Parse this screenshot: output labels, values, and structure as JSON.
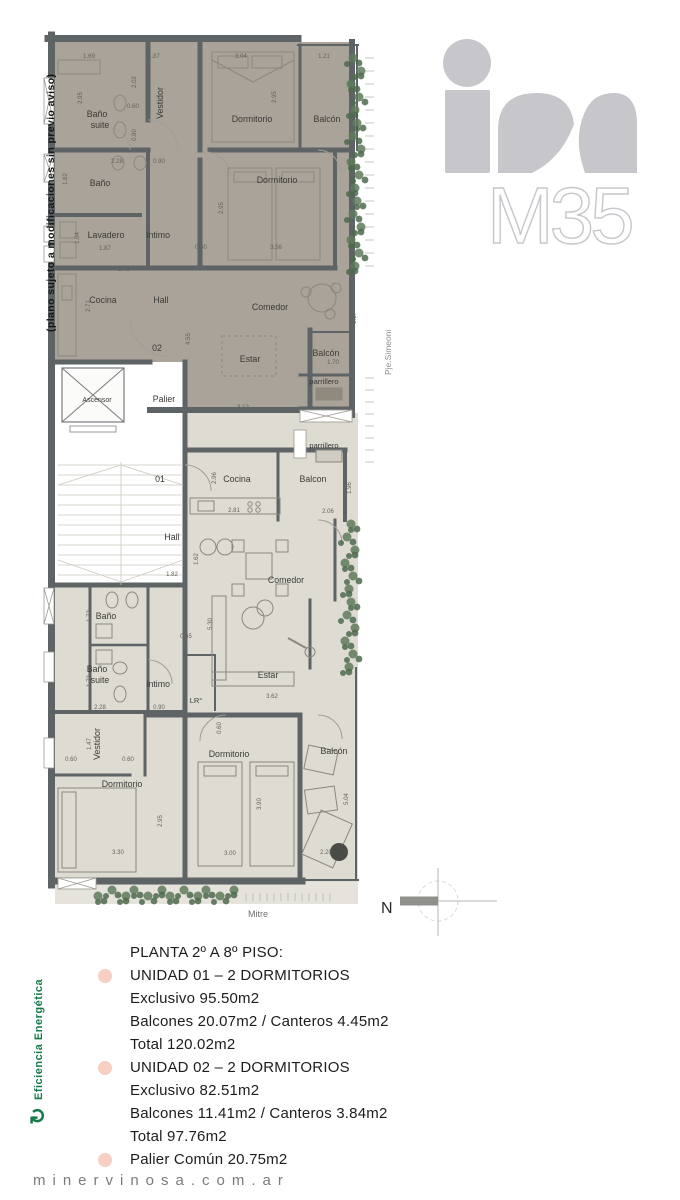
{
  "side_note": "(plano sujeto a modificaciones sin previo aviso)",
  "streets": {
    "right": "Pje.Simeoni",
    "bottom": "Mitre"
  },
  "compass": {
    "north_label": "N"
  },
  "logo": {
    "model": "M35"
  },
  "energy": {
    "label": "Eficiencia Energética",
    "icon": "refresh-arrow",
    "color": "#177a4a"
  },
  "footer": {
    "url": "minervinosa.com.ar"
  },
  "legend": {
    "title": "PLANTA 2º A 8º PISO:",
    "items": [
      {
        "bullet": true,
        "text": "UNIDAD 01 – 2 DORMITORIOS"
      },
      {
        "bullet": false,
        "text": "Exclusivo 95.50m2"
      },
      {
        "bullet": false,
        "text": "Balcones 20.07m2 / Canteros 4.45m2"
      },
      {
        "bullet": false,
        "text": "Total 120.02m2"
      },
      {
        "bullet": true,
        "text": "UNIDAD 02 – 2 DORMITORIOS"
      },
      {
        "bullet": false,
        "text": "Exclusivo 82.51m2"
      },
      {
        "bullet": false,
        "text": "Balcones 11.41m2 / Canteros 3.84m2"
      },
      {
        "bullet": false,
        "text": "Total 97.76m2"
      },
      {
        "bullet": true,
        "text": "Palier Común 20.75m2"
      }
    ]
  },
  "colors": {
    "unit01_fill": "#dedbd3",
    "unit02_fill": "#a9a399",
    "wall": "#5e6366",
    "bullet_pink": "#f7cfc3",
    "plant_green": "#5f7a5b",
    "logo_gray": "#c7c6cb"
  },
  "plan": {
    "rooms": [
      {
        "t": "Baño",
        "x": 97,
        "y": 117
      },
      {
        "t": "suite",
        "x": 100,
        "y": 128
      },
      {
        "t": "Vestidor",
        "x": 163,
        "y": 103,
        "r": -90
      },
      {
        "t": "Dormitorio",
        "x": 252,
        "y": 122
      },
      {
        "t": "Balcón",
        "x": 327,
        "y": 122
      },
      {
        "t": "Baño",
        "x": 100,
        "y": 186
      },
      {
        "t": "Dormitorio",
        "x": 277,
        "y": 183
      },
      {
        "t": "Lavadero",
        "x": 106,
        "y": 238
      },
      {
        "t": "Intimo",
        "x": 158,
        "y": 238
      },
      {
        "t": "Cocina",
        "x": 103,
        "y": 303
      },
      {
        "t": "Hall",
        "x": 161,
        "y": 303
      },
      {
        "t": "Comedor",
        "x": 270,
        "y": 310
      },
      {
        "t": "02",
        "x": 157,
        "y": 351
      },
      {
        "t": "Estar",
        "x": 250,
        "y": 362
      },
      {
        "t": "Balcón",
        "x": 326,
        "y": 356
      },
      {
        "t": "parrillero",
        "x": 324,
        "y": 384,
        "fs": 7.5
      },
      {
        "t": "Ascensor",
        "x": 97,
        "y": 402,
        "fs": 7
      },
      {
        "t": "Palier",
        "x": 164,
        "y": 402
      },
      {
        "t": "parrillero",
        "x": 324,
        "y": 448,
        "fs": 7.5
      },
      {
        "t": "01",
        "x": 160,
        "y": 482
      },
      {
        "t": "Cocina",
        "x": 237,
        "y": 482
      },
      {
        "t": "Balcon",
        "x": 313,
        "y": 482
      },
      {
        "t": "Hall",
        "x": 172,
        "y": 540
      },
      {
        "t": "Comedor",
        "x": 286,
        "y": 583
      },
      {
        "t": "Baño",
        "x": 106,
        "y": 619
      },
      {
        "t": "Baño",
        "x": 97,
        "y": 672
      },
      {
        "t": "suite",
        "x": 100,
        "y": 683
      },
      {
        "t": "Intimo",
        "x": 158,
        "y": 687
      },
      {
        "t": "Estar",
        "x": 268,
        "y": 678
      },
      {
        "t": "LR°",
        "x": 196,
        "y": 703,
        "fs": 7.5
      },
      {
        "t": "Vestidor",
        "x": 100,
        "y": 744,
        "r": -90
      },
      {
        "t": "Dormitorio",
        "x": 122,
        "y": 787
      },
      {
        "t": "Dormitorio",
        "x": 229,
        "y": 757
      },
      {
        "t": "Balcón",
        "x": 334,
        "y": 754
      }
    ],
    "dims": [
      {
        "t": "1.69",
        "x": 89,
        "y": 58
      },
      {
        "t": "1.87",
        "x": 154,
        "y": 58
      },
      {
        "t": "3.04",
        "x": 241,
        "y": 58
      },
      {
        "t": "1.21",
        "x": 324,
        "y": 58
      },
      {
        "t": "2.95",
        "x": 82,
        "y": 98,
        "r": -90
      },
      {
        "t": "2.02",
        "x": 136,
        "y": 82,
        "r": -90
      },
      {
        "t": "0.60",
        "x": 133,
        "y": 108
      },
      {
        "t": "0.80",
        "x": 136,
        "y": 135,
        "r": -90
      },
      {
        "t": "2.95",
        "x": 276,
        "y": 97,
        "r": -90
      },
      {
        "t": "0.90",
        "x": 159,
        "y": 163
      },
      {
        "t": "2.28",
        "x": 117,
        "y": 163
      },
      {
        "t": "1.82",
        "x": 67,
        "y": 179,
        "r": -90
      },
      {
        "t": "1.04",
        "x": 79,
        "y": 238,
        "r": -90
      },
      {
        "t": "1.87",
        "x": 105,
        "y": 250
      },
      {
        "t": "0.40",
        "x": 201,
        "y": 249
      },
      {
        "t": "3.56",
        "x": 276,
        "y": 249
      },
      {
        "t": "2.95",
        "x": 223,
        "y": 208,
        "r": -90
      },
      {
        "t": "2.43",
        "x": 124,
        "y": 271
      },
      {
        "t": "1.40",
        "x": 162,
        "y": 270
      },
      {
        "t": "2.71",
        "x": 90,
        "y": 306,
        "r": -90
      },
      {
        "t": "3.17",
        "x": 356,
        "y": 318,
        "r": -90
      },
      {
        "t": "4.55",
        "x": 190,
        "y": 339,
        "r": -90
      },
      {
        "t": "3.12",
        "x": 243,
        "y": 409
      },
      {
        "t": "1.70",
        "x": 333,
        "y": 364
      },
      {
        "t": "2.96",
        "x": 216,
        "y": 478,
        "r": -90
      },
      {
        "t": "2.81",
        "x": 234,
        "y": 512
      },
      {
        "t": "2.06",
        "x": 328,
        "y": 513
      },
      {
        "t": "1.96",
        "x": 351,
        "y": 488,
        "r": -90
      },
      {
        "t": "1.62",
        "x": 198,
        "y": 559,
        "r": -90
      },
      {
        "t": "1.82",
        "x": 172,
        "y": 576
      },
      {
        "t": "0.65",
        "x": 186,
        "y": 638
      },
      {
        "t": "5.30",
        "x": 212,
        "y": 624,
        "r": -90
      },
      {
        "t": "3.62",
        "x": 272,
        "y": 698
      },
      {
        "t": "0.60",
        "x": 221,
        "y": 728,
        "r": -90
      },
      {
        "t": "1.72",
        "x": 91,
        "y": 616,
        "r": -90
      },
      {
        "t": "1.73",
        "x": 91,
        "y": 681,
        "r": -90
      },
      {
        "t": "2.28",
        "x": 100,
        "y": 709
      },
      {
        "t": "0.90",
        "x": 159,
        "y": 709
      },
      {
        "t": "1.47",
        "x": 91,
        "y": 744,
        "r": -90
      },
      {
        "t": "0.60",
        "x": 71,
        "y": 761
      },
      {
        "t": "0.60",
        "x": 128,
        "y": 761
      },
      {
        "t": "3.30",
        "x": 118,
        "y": 854
      },
      {
        "t": "2.95",
        "x": 162,
        "y": 821,
        "r": -90
      },
      {
        "t": "3.00",
        "x": 230,
        "y": 855
      },
      {
        "t": "3.90",
        "x": 261,
        "y": 804,
        "r": -90
      },
      {
        "t": "5.04",
        "x": 348,
        "y": 799,
        "r": -90
      },
      {
        "t": "2.20",
        "x": 326,
        "y": 854
      }
    ]
  }
}
